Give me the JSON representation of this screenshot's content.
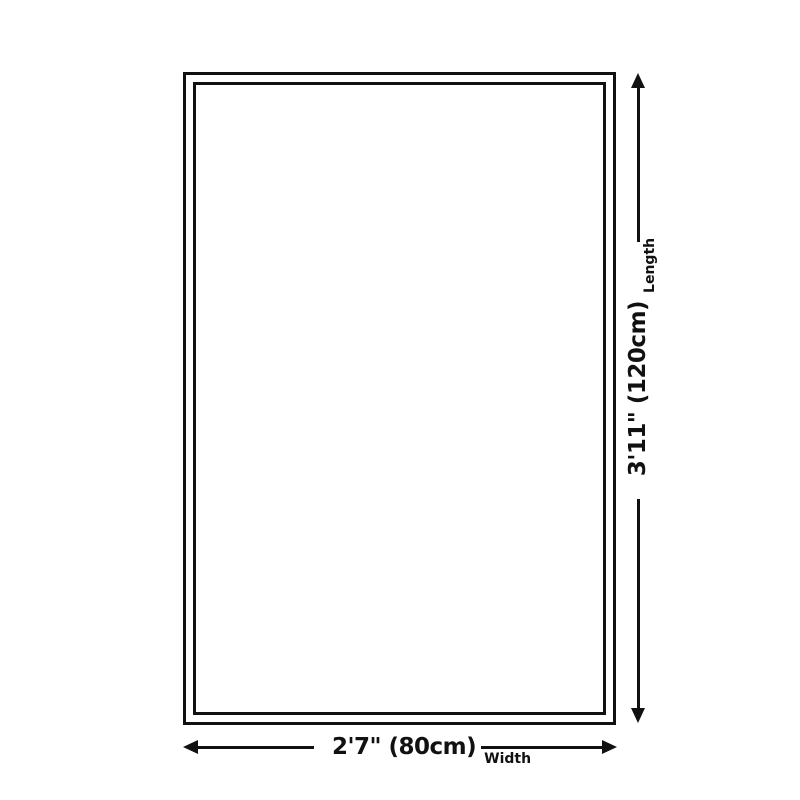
{
  "theme": {
    "background": "#ffffff",
    "line_color": "#111111",
    "text_color": "#111111"
  },
  "diagram": {
    "length_value": "3'11\" (120cm)",
    "length_label": "Length",
    "width_value": "2'7\" (80cm)",
    "width_label": "Width"
  }
}
